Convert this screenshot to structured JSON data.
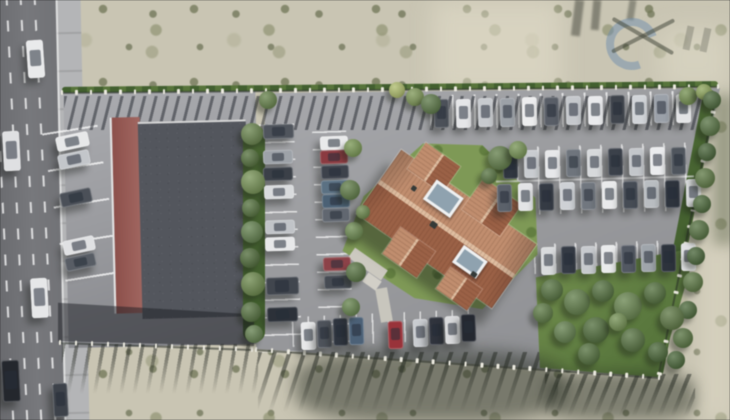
{
  "scene": {
    "width": 730,
    "height": 420,
    "type": "aerial-3d-architectural-render",
    "description": "Top-down 3D visualization of a residential building with a terracotta hip roof on a fenced plot with parking rows of cars, lawn and shrub garden; a flat-roof commercial building with parking beside a multi-lane road on the left; sandy scrubland around; faint logo watermark top-right",
    "visible_text": ""
  },
  "palette": {
    "sand": "#c9c5b2",
    "road": "#6f7074",
    "sidewalk": "#b4b5b7",
    "lot_asphalt": "#9b9ca0",
    "parcel_asphalt": "#9b9c9f",
    "flat_roof": "#53565d",
    "maroon": "#8f4f4a",
    "roof_light": "#c28d6c",
    "roof_ridge": "#e0bd9e",
    "roof_dark": "#9d6044",
    "lawn": "#7d9a53",
    "hedge": "#4a6832",
    "wm_blue": "rgba(100,135,175,0.5)",
    "wm_dark": "rgba(55,60,48,0.55)"
  },
  "road": {
    "lane_xs": [
      8,
      22,
      36,
      50
    ]
  },
  "watermark": {
    "shape": "blue C-swirl ring with crossed X strokes",
    "ring_color": "rgba(100,135,175,0.5)",
    "x_color": "rgba(55,60,48,0.55)"
  },
  "cars": [
    [
      27,
      40,
      15,
      36,
      -4,
      "#e9eaeb"
    ],
    [
      3,
      131,
      15,
      38,
      -3,
      "#dfe0e2"
    ],
    [
      31,
      278,
      15,
      38,
      -3,
      "#e6e7e8"
    ],
    [
      2,
      360,
      16,
      40,
      -3,
      "#24272d"
    ],
    [
      53,
      383,
      13,
      32,
      -3,
      "#3d424a"
    ],
    [
      56,
      134,
      31,
      13,
      -12,
      "#e7e8e9"
    ],
    [
      58,
      152,
      30,
      13,
      -12,
      "#c3c6ca"
    ],
    [
      60,
      190,
      30,
      13,
      -12,
      "#4b5058"
    ],
    [
      63,
      238,
      30,
      13,
      -12,
      "#e0e1e3"
    ],
    [
      65,
      255,
      29,
      12,
      -12,
      "#585d65"
    ],
    [
      263,
      124,
      29,
      13,
      -2,
      "#50555d"
    ],
    [
      263,
      150,
      28,
      12,
      -2,
      "#9da2a8"
    ],
    [
      263,
      167,
      28,
      12,
      -2,
      "#3b4048"
    ],
    [
      264,
      185,
      28,
      12,
      -2,
      "#d9dbdd"
    ],
    [
      265,
      220,
      28,
      12,
      -2,
      "#c1c4c8"
    ],
    [
      265,
      237,
      28,
      12,
      -2,
      "#e7e8e9"
    ],
    [
      266,
      277,
      31,
      16,
      -2,
      "#41464e"
    ],
    [
      267,
      307,
      29,
      13,
      -2,
      "#2c3139"
    ],
    [
      320,
      136,
      26,
      12,
      -2,
      "#e9eaeb"
    ],
    [
      320,
      150,
      26,
      12,
      -2,
      "#8e3a40"
    ],
    [
      321,
      165,
      26,
      12,
      -2,
      "#3d424c"
    ],
    [
      321,
      180,
      26,
      12,
      -2,
      "#5a7184"
    ],
    [
      322,
      194,
      26,
      12,
      -2,
      "#4a6176"
    ],
    [
      322,
      208,
      26,
      12,
      -2,
      "#616770"
    ],
    [
      323,
      257,
      26,
      12,
      -2,
      "#8f4147"
    ],
    [
      324,
      275,
      26,
      12,
      -2,
      "#464b53"
    ],
    [
      434,
      99,
      13,
      27,
      -1,
      "#4c5159"
    ],
    [
      456,
      99,
      13,
      27,
      -1,
      "#e5e6e8"
    ],
    [
      478,
      98,
      13,
      27,
      -1,
      "#c7cace"
    ],
    [
      500,
      98,
      13,
      27,
      -1,
      "#9ca1a7"
    ],
    [
      522,
      97,
      13,
      27,
      -1,
      "#ededee"
    ],
    [
      544,
      97,
      13,
      27,
      -1,
      "#595e67"
    ],
    [
      566,
      96,
      13,
      27,
      -1,
      "#c5c8cc"
    ],
    [
      588,
      96,
      13,
      27,
      -1,
      "#e9eaec"
    ],
    [
      610,
      95,
      13,
      27,
      -1,
      "#3f444c"
    ],
    [
      632,
      95,
      13,
      27,
      -1,
      "#d1d4d8"
    ],
    [
      654,
      94,
      13,
      27,
      -1,
      "#9ba1a9"
    ],
    [
      676,
      94,
      13,
      27,
      -1,
      "#e3e4e6"
    ],
    [
      503,
      151,
      13,
      26,
      -1,
      "#303641"
    ],
    [
      524,
      150,
      13,
      26,
      -1,
      "#c9ccd0"
    ],
    [
      545,
      150,
      13,
      26,
      -1,
      "#e7e8ea"
    ],
    [
      566,
      149,
      13,
      26,
      -1,
      "#6f757d"
    ],
    [
      587,
      149,
      13,
      26,
      -1,
      "#d7d9db"
    ],
    [
      608,
      148,
      13,
      26,
      -1,
      "#3b414b"
    ],
    [
      629,
      148,
      13,
      26,
      -1,
      "#c3c6ca"
    ],
    [
      650,
      147,
      13,
      26,
      -1,
      "#ebecee"
    ],
    [
      671,
      147,
      13,
      26,
      -1,
      "#4f555d"
    ],
    [
      497,
      184,
      13,
      26,
      -1,
      "#5b616b"
    ],
    [
      518,
      183,
      13,
      26,
      -1,
      "#e3e4e6"
    ],
    [
      539,
      183,
      13,
      26,
      -1,
      "#353b45"
    ],
    [
      560,
      182,
      13,
      26,
      -1,
      "#ced1d5"
    ],
    [
      581,
      182,
      13,
      26,
      -1,
      "#71777f"
    ],
    [
      602,
      181,
      13,
      26,
      -1,
      "#e9eaeb"
    ],
    [
      623,
      181,
      13,
      26,
      -1,
      "#464c56"
    ],
    [
      644,
      180,
      13,
      26,
      -1,
      "#b9bdc1"
    ],
    [
      665,
      180,
      13,
      26,
      -1,
      "#2e343e"
    ],
    [
      686,
      179,
      13,
      26,
      -1,
      "#d5d7d9"
    ],
    [
      541,
      247,
      13,
      26,
      -1,
      "#d9dbdd"
    ],
    [
      561,
      246,
      13,
      26,
      -1,
      "#343a45"
    ],
    [
      581,
      246,
      13,
      26,
      -1,
      "#c7cace"
    ],
    [
      601,
      245,
      13,
      26,
      -1,
      "#eaebec"
    ],
    [
      621,
      245,
      13,
      26,
      -1,
      "#525863"
    ],
    [
      641,
      244,
      13,
      26,
      -1,
      "#9fa5ab"
    ],
    [
      661,
      244,
      13,
      26,
      -1,
      "#2d333d"
    ],
    [
      681,
      243,
      13,
      26,
      -1,
      "#e0e1e3"
    ],
    [
      301,
      322,
      13,
      26,
      -2,
      "#e7e8e9"
    ],
    [
      317,
      320,
      13,
      26,
      -2,
      "#4e535b"
    ],
    [
      333,
      318,
      13,
      26,
      -2,
      "#2f3540"
    ],
    [
      349,
      317,
      13,
      26,
      -2,
      "#4b6178"
    ],
    [
      388,
      321,
      13,
      26,
      -2,
      "#9d3239"
    ],
    [
      413,
      319,
      13,
      26,
      -2,
      "#c9ccd0"
    ],
    [
      429,
      317,
      13,
      26,
      -2,
      "#30343e"
    ],
    [
      445,
      316,
      13,
      26,
      -2,
      "#d9dadc"
    ],
    [
      461,
      314,
      13,
      26,
      -2,
      "#242830"
    ]
  ],
  "bushes": [
    [
      252,
      134,
      11,
      "#5f7d40"
    ],
    [
      250,
      158,
      9,
      "#49682f"
    ],
    [
      253,
      182,
      12,
      "#6d8c49"
    ],
    [
      251,
      208,
      9,
      "#4a6a31"
    ],
    [
      252,
      232,
      11,
      "#587941"
    ],
    [
      250,
      258,
      10,
      "#44632c"
    ],
    [
      253,
      284,
      12,
      "#62813f"
    ],
    [
      251,
      312,
      10,
      "#4b6a33"
    ],
    [
      254,
      334,
      9,
      "#587841"
    ],
    [
      353,
      148,
      9,
      "#6f9046"
    ],
    [
      350,
      190,
      10,
      "#55743a"
    ],
    [
      354,
      231,
      9,
      "#648545"
    ],
    [
      356,
      272,
      10,
      "#4d6c35"
    ],
    [
      351,
      307,
      9,
      "#5b7c40"
    ],
    [
      397,
      90,
      8,
      "#a9b85f"
    ],
    [
      415,
      97,
      9,
      "#75914a"
    ],
    [
      431,
      104,
      10,
      "#51703a"
    ],
    [
      688,
      96,
      9,
      "#6b8a44"
    ],
    [
      704,
      92,
      8,
      "#87a04e"
    ],
    [
      268,
      100,
      9,
      "#5c7b3e"
    ],
    [
      712,
      100,
      9,
      "#3f5e2e"
    ],
    [
      710,
      126,
      10,
      "#4c6b36"
    ],
    [
      707,
      152,
      9,
      "#3b5a2b"
    ],
    [
      705,
      178,
      10,
      "#547238"
    ],
    [
      702,
      204,
      9,
      "#40602e"
    ],
    [
      699,
      230,
      10,
      "#4a6933"
    ],
    [
      696,
      256,
      9,
      "#3c5c2c"
    ],
    [
      693,
      282,
      10,
      "#527137"
    ],
    [
      688,
      310,
      9,
      "#41612f"
    ],
    [
      683,
      338,
      10,
      "#4d6c34"
    ],
    [
      676,
      360,
      9,
      "#3e5e2d"
    ],
    [
      552,
      290,
      11,
      "#4a6a32"
    ],
    [
      577,
      302,
      13,
      "#56763c"
    ],
    [
      603,
      291,
      11,
      "#486831"
    ],
    [
      628,
      306,
      14,
      "#5d7d41"
    ],
    [
      655,
      293,
      11,
      "#47672f"
    ],
    [
      672,
      318,
      12,
      "#526f36"
    ],
    [
      596,
      330,
      13,
      "#45652e"
    ],
    [
      565,
      332,
      11,
      "#587840"
    ],
    [
      633,
      340,
      12,
      "#4b6a33"
    ],
    [
      658,
      352,
      10,
      "#3f5f2c"
    ],
    [
      543,
      313,
      10,
      "#527237"
    ],
    [
      589,
      354,
      11,
      "#486830"
    ],
    [
      618,
      322,
      9,
      "#6a8a47"
    ],
    [
      500,
      158,
      12,
      "#57763c"
    ],
    [
      518,
      150,
      9,
      "#6d8d48"
    ],
    [
      363,
      212,
      7,
      "#62813f"
    ],
    [
      489,
      176,
      8,
      "#4d6c34"
    ]
  ],
  "fences": [
    {
      "x1": 62,
      "y1": 92,
      "x2": 718,
      "y2": 86,
      "posts": 46
    },
    {
      "x1": 60,
      "y1": 342,
      "x2": 252,
      "y2": 349,
      "posts": 13
    },
    {
      "x1": 256,
      "y1": 349,
      "x2": 659,
      "y2": 377,
      "posts": 26
    },
    {
      "x1": 716,
      "y1": 95,
      "x2": 659,
      "y2": 373,
      "posts": 18
    }
  ],
  "streaks": [
    {
      "x": 64,
      "y": 96,
      "w": 642,
      "h": 34,
      "angle": 104,
      "thick": 3,
      "period": 11,
      "c": "rgba(30,34,42,0.5)",
      "fade": false
    },
    {
      "x": 62,
      "y": 344,
      "w": 196,
      "h": 52,
      "angle": 100,
      "thick": 3.5,
      "period": 13,
      "c": "rgba(32,36,30,0.45)",
      "fade": true
    },
    {
      "x": 258,
      "y": 352,
      "w": 300,
      "h": 62,
      "angle": 108,
      "thick": 4,
      "period": 14,
      "c": "rgba(32,36,30,0.5)",
      "fade": true
    },
    {
      "x": 545,
      "y": 374,
      "w": 150,
      "h": 44,
      "angle": 112,
      "thick": 4,
      "period": 12,
      "c": "rgba(32,36,30,0.5)",
      "fade": true
    }
  ],
  "stalls": [
    {
      "x": 56,
      "y": 128,
      "w": 56,
      "h": 182,
      "dir": "h",
      "gap": 37,
      "thick": 2,
      "rot": -9,
      "c": "rgba(255,255,255,0.75)"
    },
    {
      "x": 256,
      "y": 124,
      "w": 42,
      "h": 228,
      "dir": "h",
      "gap": 17.5,
      "thick": 1.6,
      "rot": -2,
      "c": "rgba(255,255,255,0.7)"
    },
    {
      "x": 316,
      "y": 131,
      "w": 34,
      "h": 222,
      "dir": "h",
      "gap": 17.5,
      "thick": 1.6,
      "rot": -2,
      "c": "rgba(255,255,255,0.7)"
    },
    {
      "x": 430,
      "y": 93,
      "w": 262,
      "h": 34,
      "dir": "v",
      "gap": 22,
      "thick": 1.8,
      "rot": -1,
      "c": "rgba(255,255,255,0.7)"
    },
    {
      "x": 496,
      "y": 145,
      "w": 198,
      "h": 68,
      "dir": "v",
      "gap": 21,
      "thick": 1.6,
      "rot": -1.5,
      "c": "rgba(255,255,255,0.65)"
    },
    {
      "x": 534,
      "y": 242,
      "w": 156,
      "h": 30,
      "dir": "v",
      "gap": 20.5,
      "thick": 1.6,
      "rot": -1.5,
      "c": "rgba(255,255,255,0.65)"
    },
    {
      "x": 292,
      "y": 313,
      "w": 186,
      "h": 30,
      "dir": "v",
      "gap": 16,
      "thick": 1.6,
      "rot": -2.5,
      "c": "rgba(255,255,255,0.65)"
    }
  ],
  "patches_under": [
    {
      "x": 432,
      "y": 0,
      "w": 130,
      "h": 95,
      "c": "rgba(228,223,203,0.55)",
      "blur": 12,
      "name": "sand-light-patch"
    },
    {
      "x": 660,
      "y": 28,
      "w": 70,
      "h": 62,
      "c": "rgba(226,221,201,0.5)",
      "blur": 12,
      "name": "sand-light-patch"
    },
    {
      "x": 700,
      "y": 240,
      "w": 34,
      "h": 180,
      "c": "rgba(225,219,199,0.5)",
      "blur": 10,
      "name": "sand-light-patch"
    }
  ],
  "patches_over": [
    {
      "x": 58,
      "y": 298,
      "w": 196,
      "h": 48,
      "c": "rgba(28,30,36,0.5)",
      "clip": "polygon(0 10%, 100% 34%, 100% 100%, 0 90%)",
      "name": "building-cast-shadow"
    },
    {
      "x": 295,
      "y": 350,
      "w": 270,
      "h": 72,
      "c": "rgba(40,46,35,0.5)",
      "blur": 8,
      "rad": "35%",
      "name": "hedge-cast-shadow"
    },
    {
      "x": 545,
      "y": 372,
      "w": 150,
      "h": 48,
      "c": "rgba(36,42,32,0.45)",
      "blur": 7,
      "rad": "30%",
      "name": "hedge-cast-shadow"
    },
    {
      "x": 714,
      "y": 95,
      "w": 20,
      "h": 150,
      "c": "rgba(70,80,52,0.35)",
      "blur": 6,
      "name": "scrub-dark-patch"
    },
    {
      "x": 573,
      "y": 0,
      "w": 9,
      "h": 36,
      "c": "rgba(48,52,42,0.45)",
      "rot": 7,
      "blur": 1,
      "name": "tree-shadow"
    },
    {
      "x": 592,
      "y": 0,
      "w": 8,
      "h": 30,
      "c": "rgba(48,52,42,0.45)",
      "rot": 5,
      "blur": 1,
      "name": "tree-shadow"
    },
    {
      "x": 628,
      "y": 0,
      "w": 7,
      "h": 20,
      "c": "rgba(48,52,42,0.4)",
      "rot": 9,
      "blur": 1,
      "name": "tree-shadow"
    },
    {
      "x": 496,
      "y": 178,
      "w": 198,
      "h": 1.6,
      "c": "rgba(255,255,255,0.6)",
      "rot": -1.5,
      "name": "stall-divider-line"
    },
    {
      "x": 348,
      "y": 258,
      "w": 40,
      "h": 12,
      "c": "#ccc9c0",
      "rot": 35,
      "name": "walkway"
    },
    {
      "x": 378,
      "y": 288,
      "w": 12,
      "h": 34,
      "c": "#c8c6bd",
      "rot": -10,
      "name": "walkway"
    },
    {
      "x": 364,
      "y": 276,
      "w": 16,
      "h": 11,
      "c": "#d2cfc7",
      "rot": 35,
      "name": "entrance-patio"
    }
  ]
}
